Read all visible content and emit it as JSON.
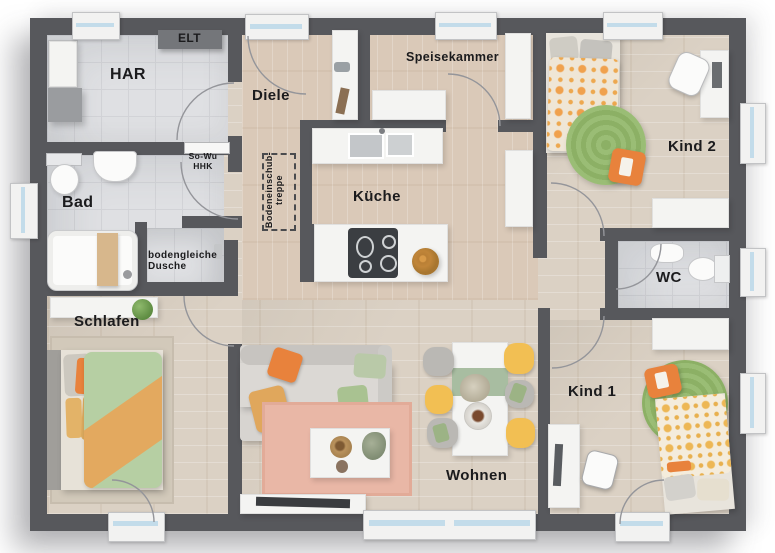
{
  "rooms": {
    "har": "HAR",
    "elt": "ELT",
    "diele": "Diele",
    "speisekammer": "Speisekammer",
    "kind2": "Kind 2",
    "sowu_hhk": "So-Wu\nHHK",
    "bad": "Bad",
    "kueche": "Küche",
    "bodeneinschubtreppe": "Bodeneinschub-\ntreppe",
    "dusche": "bodengleiche\nDusche",
    "wc": "WC",
    "schlafen": "Schlafen",
    "kind1": "Kind 1",
    "wohnen": "Wohnen"
  },
  "colors": {
    "wall": "#57585c",
    "wood_floor": "#dbd1c4",
    "hall_floor": "#dac9b8",
    "tile_floor": "#dfe0e3",
    "accent_orange": "#e8823c",
    "rug_green": "#8cb065",
    "chair_yellow": "#f2bf53",
    "rug_pink": "#e9b7a6",
    "duvet_green": "#b6cfa3",
    "window_glass": "#c3dcea"
  }
}
